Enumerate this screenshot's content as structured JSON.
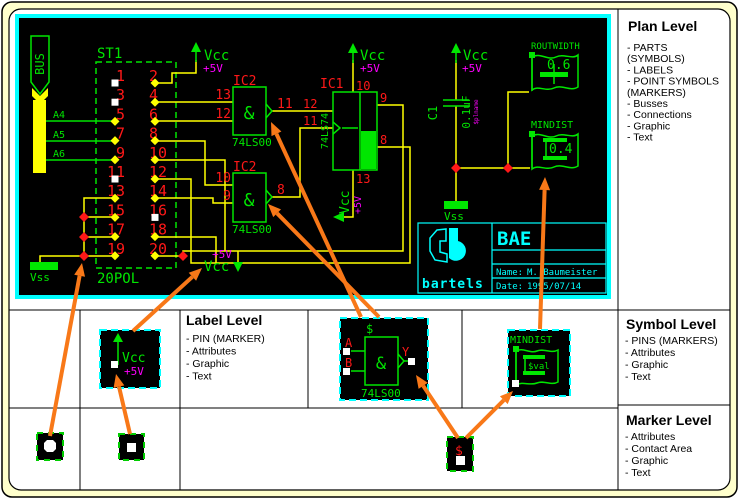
{
  "palette": {
    "page_bg": "#FFFFCC",
    "screen_bg": "#000000",
    "screen_frame": "#00FFFF",
    "wire": "#FFFF00",
    "symbol_green": "#00E600",
    "label_red": "#FF1818",
    "power_magenta": "#FF00FF",
    "titleblock_cyan": "#00FFFF",
    "arrow_orange": "#F87818"
  },
  "plan": {
    "bus": {
      "label": "BUS",
      "taps": [
        "A4",
        "A5",
        "A6"
      ]
    },
    "connector": {
      "designator": "ST1",
      "package": "20POL",
      "left_pins": [
        "1",
        "3",
        "5",
        "7",
        "9",
        "11",
        "13",
        "15",
        "17",
        "19"
      ],
      "right_pins": [
        "2",
        "4",
        "6",
        "8",
        "10",
        "12",
        "14",
        "16",
        "18",
        "20"
      ],
      "left_marker_types": [
        "open",
        "open",
        "pin",
        "pin",
        "pin",
        "open",
        "pin",
        "pin",
        "pin",
        "pin"
      ],
      "right_marker_types": [
        "pin",
        "pin",
        "pin",
        "pin",
        "pin",
        "pin",
        "pin",
        "open",
        "pin",
        "pin"
      ]
    },
    "power": {
      "vcc": "Vcc",
      "rail": "+5V",
      "gnd": "Vss"
    },
    "gate1": {
      "designator": "IC2",
      "body": "&",
      "part": "74LS00",
      "pin_in1": "13",
      "pin_in2": "12",
      "pin_out": "11"
    },
    "gate2": {
      "designator": "IC2",
      "body": "&",
      "part": "74LS00",
      "pin_in1": "10",
      "pin_in2": "9",
      "pin_out": "8"
    },
    "ic1": {
      "designator": "IC1",
      "part": "74LS74",
      "pin_top": "10",
      "pin_left1": "12",
      "pin_left2": "11",
      "pin_right1": "9",
      "pin_right2": "8",
      "pin_bottom": "13"
    },
    "cap": {
      "designator": "C1",
      "value": "0.1uF",
      "attribute": "$plname"
    },
    "flag_routwidth": {
      "name": "ROUTWIDTH",
      "value": "0.6"
    },
    "flag_mindist": {
      "name": "MINDIST",
      "value": "0.4"
    },
    "titleblock": {
      "product": "BAE",
      "logo": "bartels",
      "name_label": "Name:",
      "name": "M. Baumeister",
      "date_label": "Date:",
      "date": "1995/07/14"
    }
  },
  "levels": {
    "plan": {
      "title": "Plan Level",
      "items": [
        "- PARTS",
        "  (SYMBOLS)",
        "- LABELS",
        "- POINT SYMBOLS",
        "  (MARKERS)",
        "- Busses",
        "- Connections",
        "- Graphic",
        "- Text"
      ]
    },
    "label": {
      "title": "Label Level",
      "items": [
        "- PIN (MARKER)",
        "- Attributes",
        "- Graphic",
        "- Text"
      ]
    },
    "symbol": {
      "title": "Symbol Level",
      "items": [
        "- PINS (MARKERS)",
        "- Attributes",
        "- Graphic",
        "- Text"
      ]
    },
    "marker": {
      "title": "Marker Level",
      "items": [
        "- Attributes",
        "- Contact Area",
        "- Graphic",
        "- Text"
      ]
    }
  },
  "symbols": {
    "vcc": {
      "name": "Vcc",
      "value": "+5V"
    },
    "gate": {
      "placeholder": "$",
      "pin_a": "A",
      "pin_b": "B",
      "pin_y": "Y",
      "body": "&",
      "part": "74LS00"
    },
    "mindist": {
      "name": "MINDIST",
      "value": "$val"
    },
    "marker": {
      "attribute": "$"
    }
  }
}
